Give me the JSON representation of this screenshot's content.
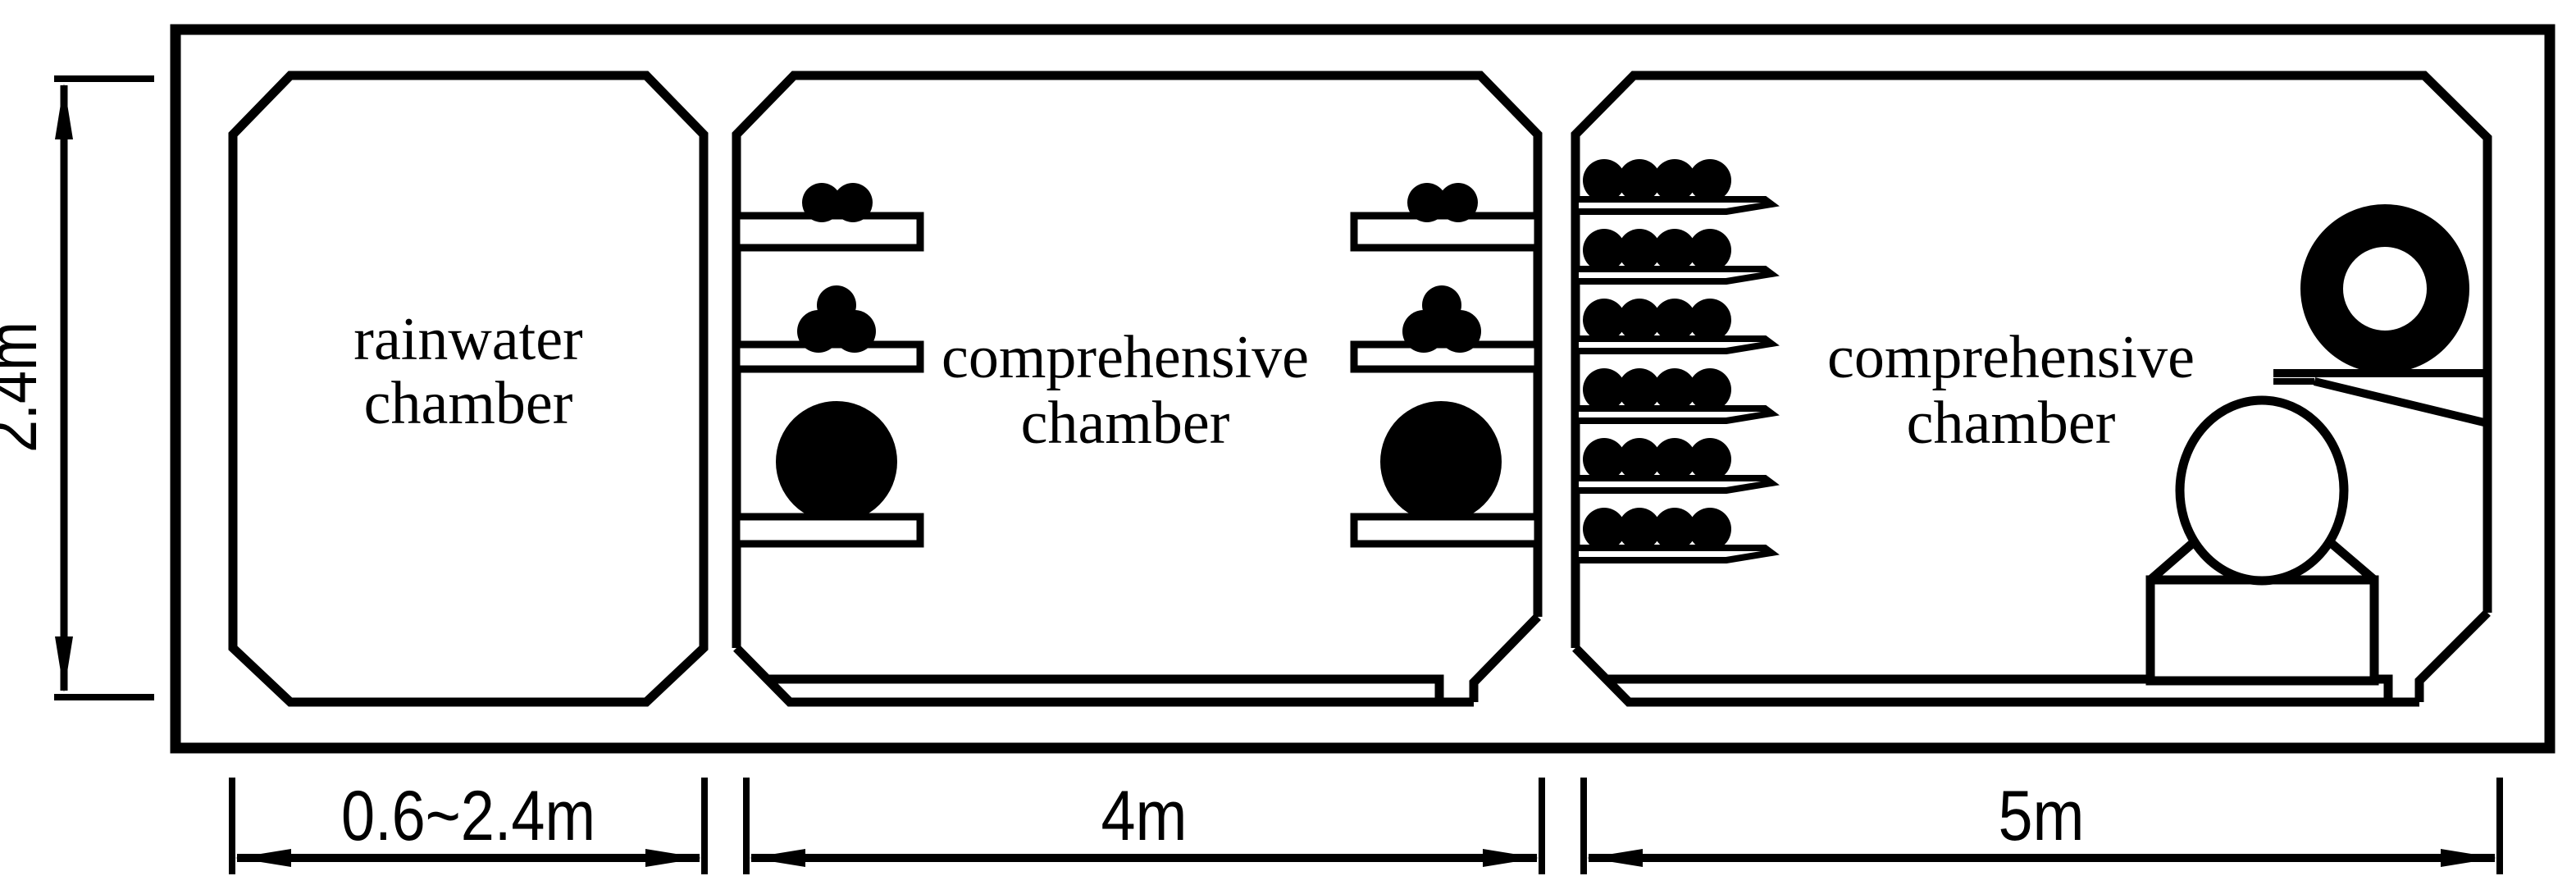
{
  "diagram": {
    "type": "utility-tunnel-cross-section",
    "chambers": [
      {
        "name": "rainwater chamber",
        "label_line1": "rainwater",
        "label_line2": "chamber",
        "width_label": "0.6~2.4m"
      },
      {
        "name": "comprehensive chamber with cable shelves and pipe",
        "label_line1": "comprehensive",
        "label_line2": "chamber",
        "width_label": "4m"
      },
      {
        "name": "comprehensive chamber with cable trays, coiled cable and pipe on pedestal",
        "label_line1": "comprehensive",
        "label_line2": "chamber",
        "width_label": "5m"
      }
    ],
    "dimensions": {
      "height_label": "2.4m",
      "widths": [
        "0.6~2.4m",
        "4m",
        "5m"
      ]
    },
    "colors": {
      "line": "#000000",
      "background": "#ffffff",
      "solid_fill": "#000000"
    }
  }
}
